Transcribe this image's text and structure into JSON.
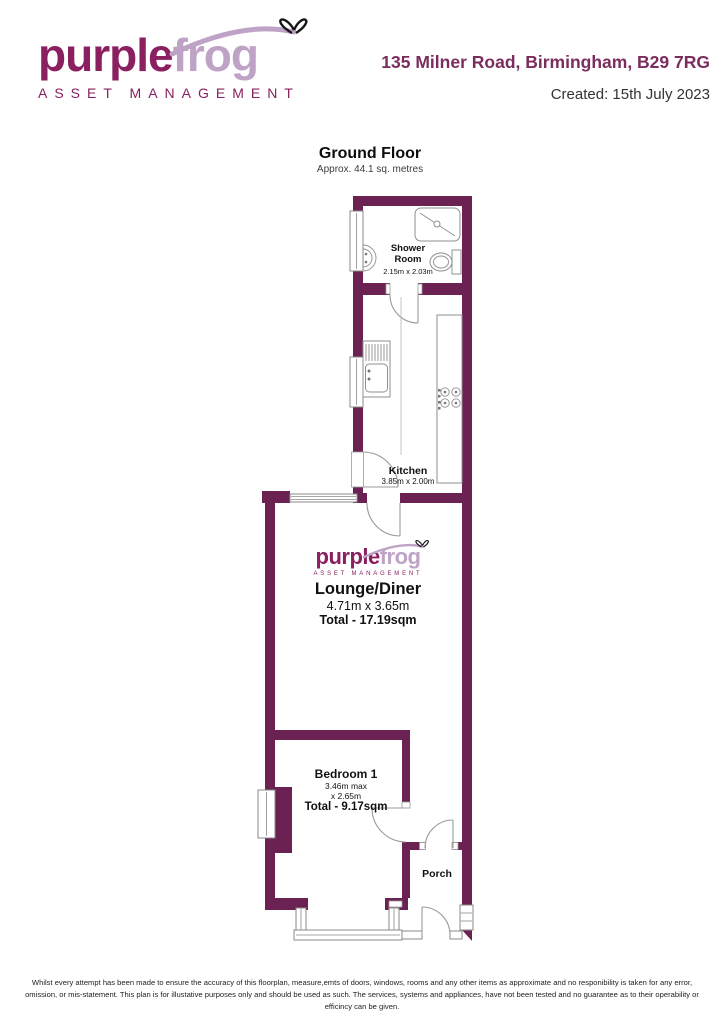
{
  "colors": {
    "wall": "#6B2152",
    "brand_dark": "#8A2060",
    "brand_light": "#BFA3C6",
    "frame_gray": "#8a8a8a"
  },
  "header": {
    "logo": {
      "part1": "purple",
      "part2": "frog",
      "tagline": "ASSET MANAGEMENT"
    },
    "address": "135 Milner Road, Birmingham, B29 7RG",
    "created": "Created: 15th July 2023"
  },
  "plan": {
    "title": "Ground Floor",
    "subtitle": "Approx. 44.1 sq. metres",
    "watermark": {
      "part1": "purple",
      "part2": "frog",
      "tagline": "ASSET MANAGEMENT"
    },
    "rooms": [
      {
        "id": "shower",
        "name": "Shower Room",
        "dims": "2.15m x 2.03m"
      },
      {
        "id": "kitchen",
        "name": "Kitchen",
        "dims": "3.85m x 2.00m"
      },
      {
        "id": "lounge",
        "name": "Lounge/Diner",
        "dims": "4.71m x 3.65m",
        "total": "Total - 17.19sqm"
      },
      {
        "id": "bedroom",
        "name": "Bedroom 1",
        "dims": "3.46m max",
        "dims2": "x 2.65m",
        "total": "Total - 9.17sqm"
      },
      {
        "id": "porch",
        "name": "Porch"
      }
    ]
  },
  "footer": {
    "disclaimer": "Whilst every attempt has been made to ensure the accuracy of this floorplan, measure,emts of doors, windows, rooms and any other items as approximate and no responibility is taken for any error, omission, or mis-statement. This plan is for illustative purposes only and should be used as such. The services, systems and appliances, have not been tested and no guarantee as to their operability or efficincy can be given."
  }
}
